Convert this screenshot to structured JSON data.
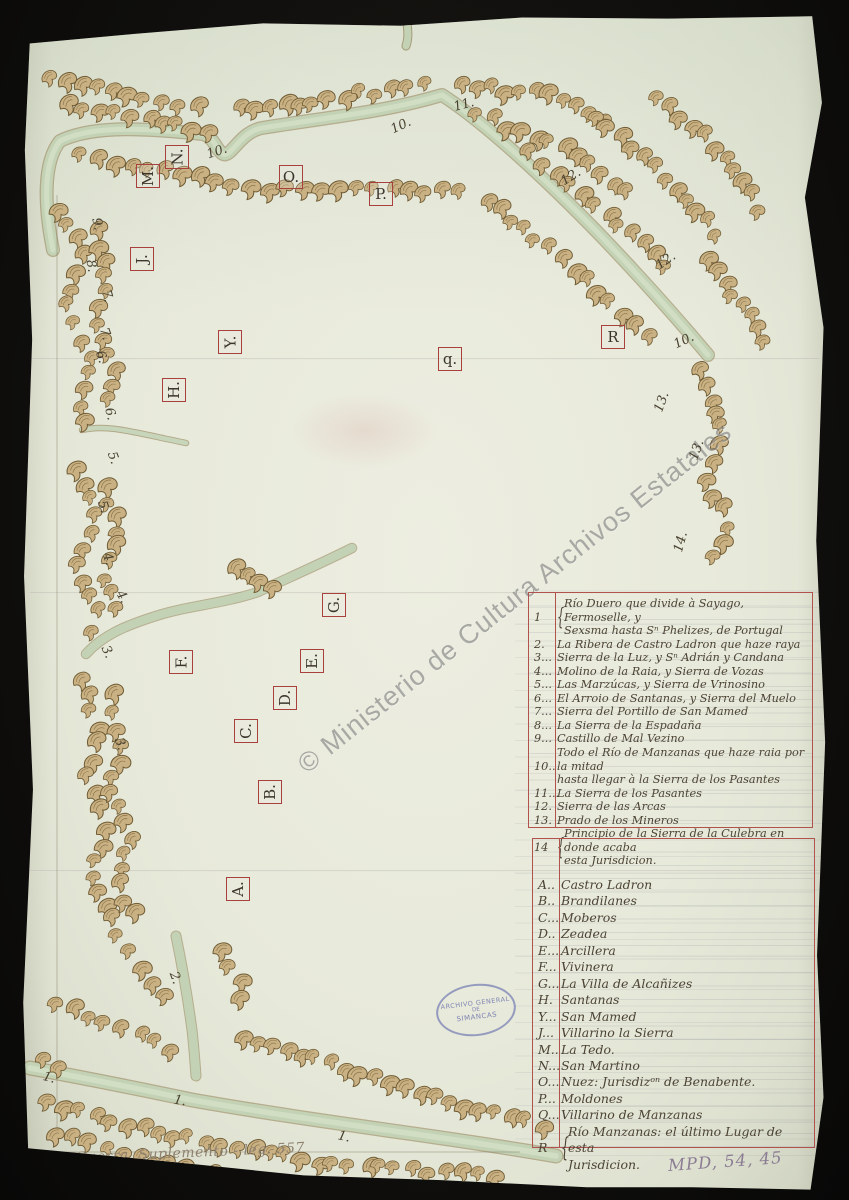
{
  "watermark": {
    "text": "© Ministerio de Cultura Archivos Estatales"
  },
  "stamp": {
    "line1": "ARCHIVO GENERAL",
    "line2": "DE",
    "line3": "SIMANCAS"
  },
  "annotations": {
    "bottom_left_note": "Sª de Guerra. Suplemento - leg. 557",
    "reference_number": "MPD, 54, 45"
  },
  "colors": {
    "paper": "#e7e9da",
    "ink": "#4c4334",
    "marker_box_red": "#a8403e",
    "river_green": "#c3d2b5",
    "hill_tan": "#c9b183",
    "hill_outline": "#6f5b34",
    "stamp_blue": "#7a80b4",
    "watermark_gray": "#5f5f5f"
  },
  "map": {
    "letter_markers": [
      {
        "label": "M.",
        "x": 148,
        "y": 176,
        "rot": -90
      },
      {
        "label": "N.",
        "x": 177,
        "y": 157,
        "rot": -90
      },
      {
        "label": "O.",
        "x": 291,
        "y": 177,
        "rot": 0
      },
      {
        "label": "P.",
        "x": 381,
        "y": 194,
        "rot": 0
      },
      {
        "label": "J.",
        "x": 142,
        "y": 259,
        "rot": -90
      },
      {
        "label": "Y.",
        "x": 230,
        "y": 342,
        "rot": -90
      },
      {
        "label": "H.",
        "x": 174,
        "y": 390,
        "rot": -90
      },
      {
        "label": "R",
        "x": 613,
        "y": 337,
        "rot": 0
      },
      {
        "label": "q.",
        "x": 450,
        "y": 359,
        "rot": 0
      },
      {
        "label": "G.",
        "x": 334,
        "y": 605,
        "rot": -90
      },
      {
        "label": "E.",
        "x": 312,
        "y": 661,
        "rot": -90
      },
      {
        "label": "F.",
        "x": 181,
        "y": 662,
        "rot": -90
      },
      {
        "label": "D.",
        "x": 285,
        "y": 698,
        "rot": -90
      },
      {
        "label": "C.",
        "x": 246,
        "y": 731,
        "rot": -90
      },
      {
        "label": "B.",
        "x": 270,
        "y": 792,
        "rot": -90
      },
      {
        "label": "A.",
        "x": 238,
        "y": 889,
        "rot": -90
      }
    ],
    "number_markers": [
      {
        "label": "9.",
        "x": 97,
        "y": 224,
        "rot": 78
      },
      {
        "label": "8.",
        "x": 91,
        "y": 266,
        "rot": 80
      },
      {
        "label": "7.",
        "x": 107,
        "y": 296,
        "rot": 75
      },
      {
        "label": "7.",
        "x": 105,
        "y": 334,
        "rot": 72
      },
      {
        "label": "6.",
        "x": 101,
        "y": 357,
        "rot": 70
      },
      {
        "label": "6.",
        "x": 110,
        "y": 414,
        "rot": 75
      },
      {
        "label": "5.",
        "x": 113,
        "y": 458,
        "rot": 70
      },
      {
        "label": "5.",
        "x": 103,
        "y": 507,
        "rot": 72
      },
      {
        "label": "4.",
        "x": 108,
        "y": 559,
        "rot": 70
      },
      {
        "label": "4.",
        "x": 122,
        "y": 597,
        "rot": 60
      },
      {
        "label": "3.",
        "x": 107,
        "y": 652,
        "rot": 65
      },
      {
        "label": "3.",
        "x": 120,
        "y": 744,
        "rot": 70
      },
      {
        "label": "10.",
        "x": 217,
        "y": 152,
        "rot": -18
      },
      {
        "label": "10.",
        "x": 401,
        "y": 126,
        "rot": -25
      },
      {
        "label": "11.",
        "x": 464,
        "y": 105,
        "rot": -15
      },
      {
        "label": "12.",
        "x": 571,
        "y": 177,
        "rot": -32
      },
      {
        "label": "12.",
        "x": 666,
        "y": 261,
        "rot": -35
      },
      {
        "label": "10.",
        "x": 684,
        "y": 341,
        "rot": -25
      },
      {
        "label": "13.",
        "x": 662,
        "y": 402,
        "rot": -70
      },
      {
        "label": "13.",
        "x": 697,
        "y": 450,
        "rot": -70
      },
      {
        "label": "14.",
        "x": 681,
        "y": 542,
        "rot": -75
      },
      {
        "label": "2.",
        "x": 175,
        "y": 978,
        "rot": 70
      },
      {
        "label": "1.",
        "x": 49,
        "y": 1078,
        "rot": 15
      },
      {
        "label": "1.",
        "x": 180,
        "y": 1101,
        "rot": 10
      },
      {
        "label": "1.",
        "x": 344,
        "y": 1137,
        "rot": 12
      }
    ]
  },
  "legend": {
    "numbered": [
      {
        "k": "1",
        "brace": true,
        "lines": [
          "Río Duero que divide à Sayago, Fermoselle, y",
          "Sexsma hasta Sⁿ Phelizes, de Portugal"
        ]
      },
      {
        "k": "2.",
        "lines": [
          "La Ribera de Castro Ladron que haze raya"
        ]
      },
      {
        "k": "3...",
        "lines": [
          "Sierra de la Luz, y Sⁿ Adrián y Candana"
        ]
      },
      {
        "k": "4...",
        "lines": [
          "Molino de la Raia, y Sierra de Vozas"
        ]
      },
      {
        "k": "5...",
        "lines": [
          "Las Marzúcas, y Sierra de Vrinosino"
        ]
      },
      {
        "k": "6...",
        "lines": [
          "El Arroio de Santanas, y Sierra del Muelo"
        ]
      },
      {
        "k": "7...",
        "lines": [
          "Sierra del Portillo de San Mamed"
        ]
      },
      {
        "k": "8...",
        "lines": [
          "La Sierra de la Espadaña"
        ]
      },
      {
        "k": "9...",
        "lines": [
          "Castillo de Mal Vezino"
        ]
      },
      {
        "k": "10..",
        "lines": [
          "Todo el Río de Manzanas que haze raia por la mitad",
          "hasta llegar à la Sierra de los Pasantes"
        ]
      },
      {
        "k": "11...",
        "lines": [
          "La Sierra de los Pasantes"
        ]
      },
      {
        "k": "12.",
        "lines": [
          "Sierra de las Arcas"
        ]
      },
      {
        "k": "13.",
        "lines": [
          "Prado de los Mineros"
        ]
      },
      {
        "k": "14",
        "brace": true,
        "lines": [
          "Principio de la Sierra de la Culebra en donde acaba",
          "esta Jurisdicion."
        ]
      }
    ],
    "lettered": [
      {
        "k": "A..",
        "lines": [
          "Castro Ladron"
        ]
      },
      {
        "k": "B..",
        "lines": [
          "Brandilanes"
        ]
      },
      {
        "k": "C...",
        "lines": [
          "Moberos"
        ]
      },
      {
        "k": "D..",
        "lines": [
          "Zeadea"
        ]
      },
      {
        "k": "E...",
        "lines": [
          "Arcillera"
        ]
      },
      {
        "k": "F...",
        "lines": [
          "Vivinera"
        ]
      },
      {
        "k": "G...",
        "lines": [
          "La Villa de Alcañizes"
        ]
      },
      {
        "k": "H.",
        "lines": [
          "Santanas"
        ]
      },
      {
        "k": "Y...",
        "lines": [
          "San Mamed"
        ]
      },
      {
        "k": "J...",
        "lines": [
          "Villarino la Sierra"
        ]
      },
      {
        "k": "M..",
        "lines": [
          "La Tedo."
        ]
      },
      {
        "k": "N...",
        "lines": [
          "San Martino"
        ]
      },
      {
        "k": "O...",
        "lines": [
          "Nuez: Jurisdizᵒⁿ de Benabente."
        ]
      },
      {
        "k": "P...",
        "lines": [
          "Moldones"
        ]
      },
      {
        "k": "Q...",
        "lines": [
          "Villarino de Manzanas"
        ]
      },
      {
        "k": "R",
        "brace": true,
        "lines": [
          "Río Manzanas: el último Lugar de esta",
          "Jurisdicion."
        ]
      }
    ]
  }
}
